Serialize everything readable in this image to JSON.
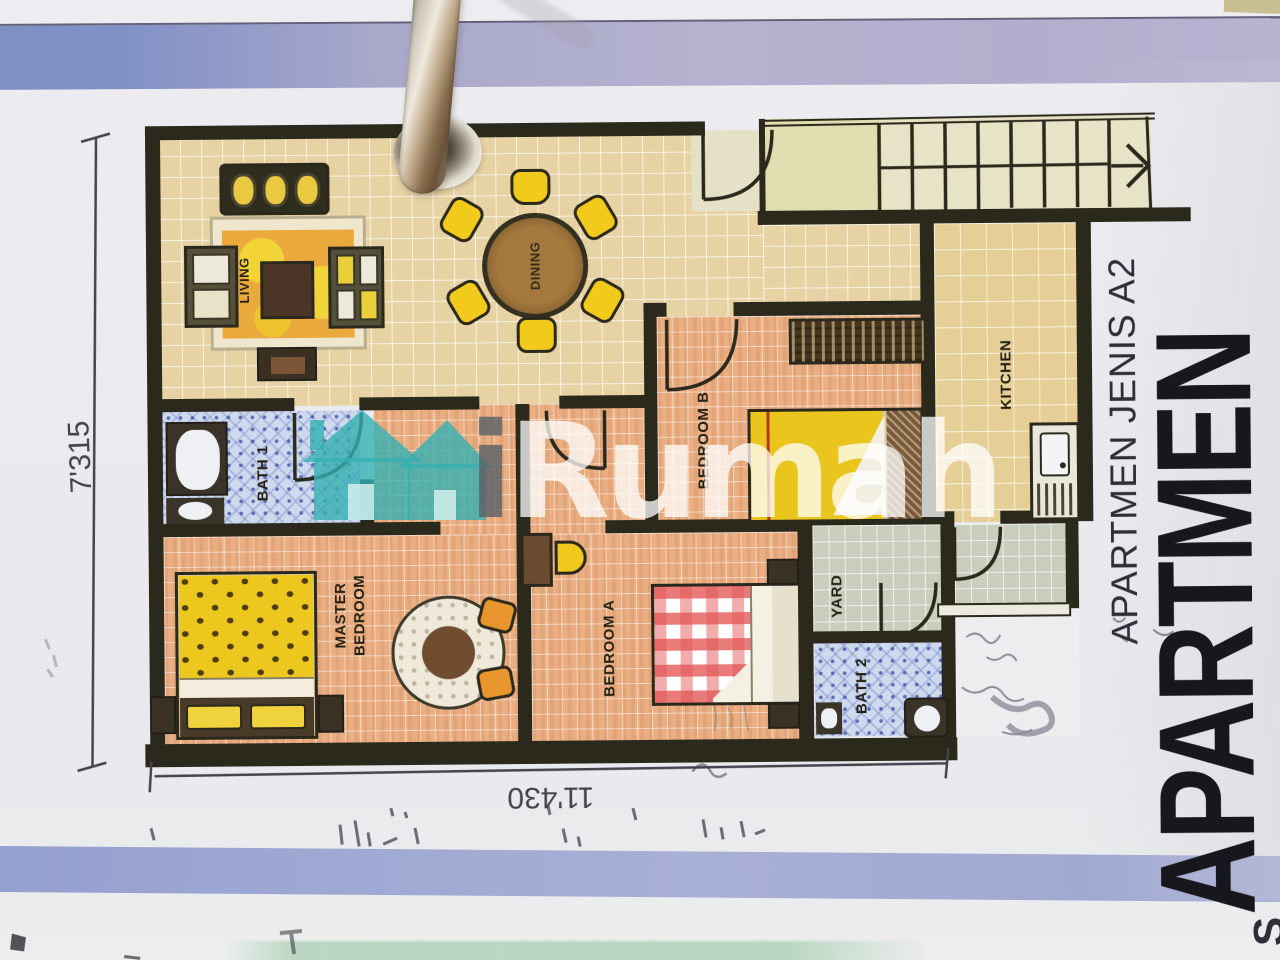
{
  "card": {
    "rooms": {
      "living": "LIVING",
      "dining": "DINING",
      "kitchen": "KITCHEN",
      "bath1": "BATH 1",
      "bedroom_b": "BEDROOM B",
      "master_1": "MASTER",
      "master_2": "BEDROOM",
      "bedroom_a": "BEDROOM A",
      "yard": "YARD",
      "bath2": "BATH 2"
    },
    "dims": {
      "height": "7'315",
      "width": "11'430"
    },
    "type_label": "APARTMEN JENIS A2",
    "big_title": "APARTMEN",
    "corner_letter": "S"
  },
  "watermark": {
    "i": "i",
    "rest": "Rumah"
  },
  "colors": {
    "watermark_teal": "#35b2b4",
    "band_blue": "#8191c5",
    "band_lavender": "#b2b0ce",
    "wall": "#2b281c",
    "tile_tan": "#e6d2a2",
    "tile_salmon": "#e9af83",
    "tile_bath_blue": "#cfd9ee",
    "tile_yard": "#c9cdbd",
    "furniture_yellow": "#f0c81e",
    "table_brown": "#a97a3f"
  }
}
